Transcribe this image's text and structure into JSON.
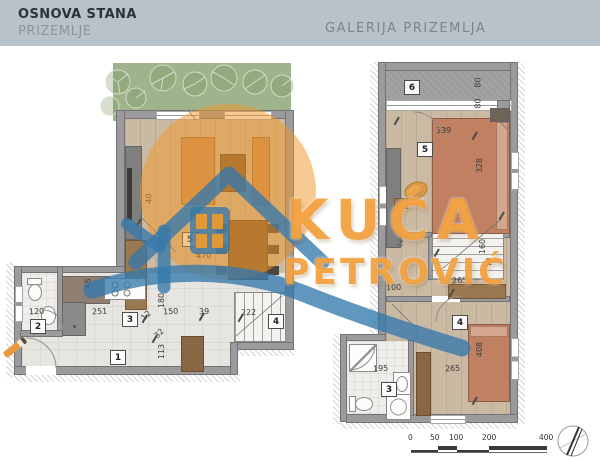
{
  "header": {
    "title": "OSNOVA STANA",
    "subtitle": "PRIZEMLJE",
    "right_title": "GALERIJA PRIZEMLJA"
  },
  "watermark": {
    "line1": "KUĆA",
    "line2": "PETROVIĆ",
    "accent_orange": "#f09828",
    "accent_blue": "#3478ac"
  },
  "plan_left": {
    "labels": {
      "r1": "1",
      "r2": "2",
      "r3": "3",
      "r4": "4",
      "r5": "5",
      "d470": "470",
      "d40": "40",
      "d45": "45",
      "d120": "120",
      "d113": "113",
      "d150": "150",
      "d180": "180",
      "d251": "251",
      "d12": "12",
      "d32": "32",
      "d39": "39",
      "d222": "222"
    }
  },
  "plan_right": {
    "labels": {
      "r1": "1",
      "r2": "2",
      "r3": "3",
      "r4": "4",
      "r5": "5",
      "r6": "6",
      "d80a": "80",
      "d80b": "80",
      "d100": "100",
      "d160": "160",
      "d195": "195",
      "d265a": "265",
      "d265b": "265",
      "d328": "328",
      "d339": "339",
      "d408": "408"
    }
  },
  "scale_bar": {
    "t0": "0",
    "t50": "50",
    "t100": "100",
    "t200": "200",
    "t400": "400"
  },
  "colors": {
    "header_bg": "#b8c2c8",
    "wall": "#9b9b9d",
    "wood_floor": "#cbbaa3",
    "tile_floor": "#e7e5e0",
    "garden": "#9fb48c",
    "terrace": "#9d9d9d",
    "bed": "#c08061",
    "furniture": "#7c5b39"
  }
}
